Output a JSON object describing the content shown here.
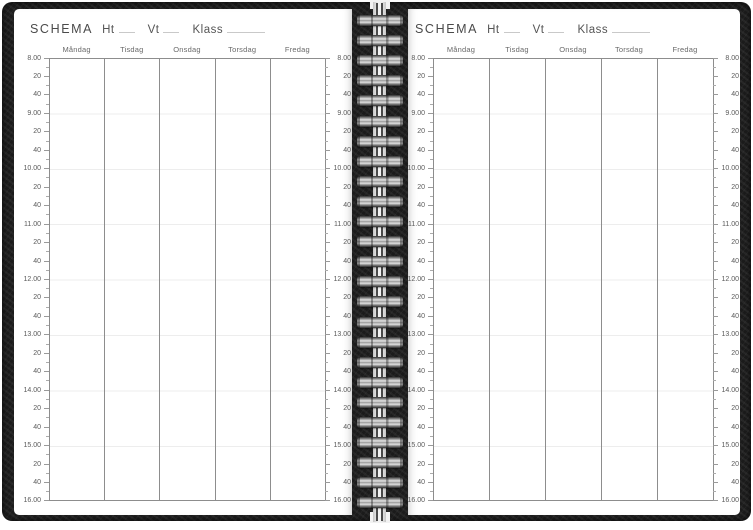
{
  "header": {
    "title": "SCHEMA",
    "ht_label": "Ht",
    "vt_label": "Vt",
    "klass_label": "Klass"
  },
  "days": [
    "Måndag",
    "Tisdag",
    "Onsdag",
    "Torsdag",
    "Fredag"
  ],
  "times": [
    "8.00",
    "20",
    "40",
    "9.00",
    "20",
    "40",
    "10.00",
    "20",
    "40",
    "11.00",
    "20",
    "40",
    "12.00",
    "20",
    "40",
    "13.00",
    "20",
    "40",
    "14.00",
    "20",
    "40",
    "15.00",
    "20",
    "40",
    "16.00"
  ],
  "binding": {
    "rung_count": 25
  },
  "colors": {
    "paper": "#ffffff",
    "cover_black": "#1b1b1b",
    "ink_text": "#4f4f4f",
    "grid_line": "#8d8d8d",
    "faint_hour_line": "#ededed",
    "underline": "#c9c9c9",
    "wire_metal_dark": "#2f2f2f",
    "wire_metal_light": "#e6e6e6"
  }
}
